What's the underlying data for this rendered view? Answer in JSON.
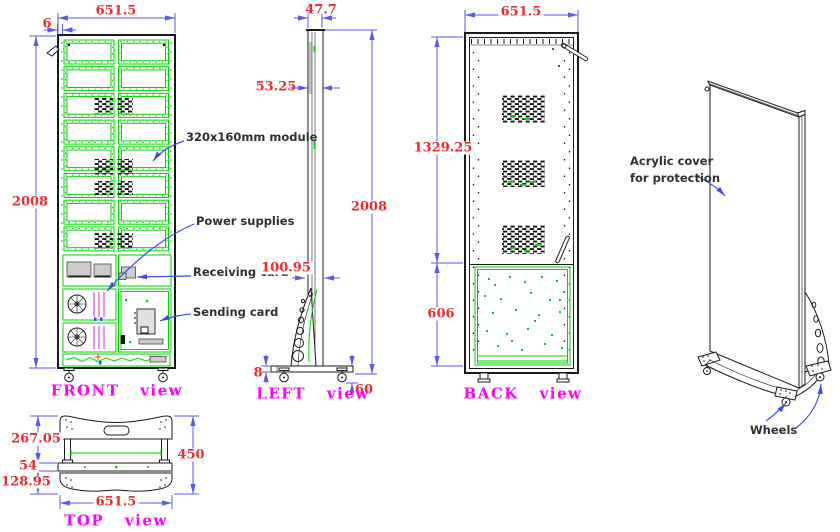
{
  "colors": {
    "red": "#f02a2a",
    "blue": "#5a5af0",
    "magenta": "#ff00ff",
    "green": "#00d400",
    "ink": "#1b1b1b",
    "note": "#2f2f2f",
    "leader": "#3c50e8"
  },
  "views": {
    "front": {
      "label": "FRONT view",
      "dim_width": "651.5",
      "dim_edge": "6",
      "dim_height": "2008",
      "notes": {
        "module": "320x160mm module",
        "power": "Power supplies",
        "receiving": "Receiving card",
        "sending": "Sending card"
      }
    },
    "left": {
      "label": "LEFT view",
      "dim_depth": "47.7",
      "dim_thickness": "53.25",
      "dim_height": "2008",
      "dim_stand": "100.95",
      "dim_base": "8",
      "dim_wheel": "60"
    },
    "back": {
      "label": "BACK view",
      "dim_width": "651.5",
      "dim_upper": "1329.25",
      "dim_lower": "606"
    },
    "top": {
      "label": "TOP view",
      "dim_front": "267.05",
      "dim_bar": "54",
      "dim_back": "128.95",
      "dim_total": "450",
      "dim_width": "651.5"
    },
    "iso": {
      "notes": {
        "acrylic_line1": "Acrylic cover",
        "acrylic_line2": "for protection",
        "wheels": "Wheels"
      }
    }
  }
}
